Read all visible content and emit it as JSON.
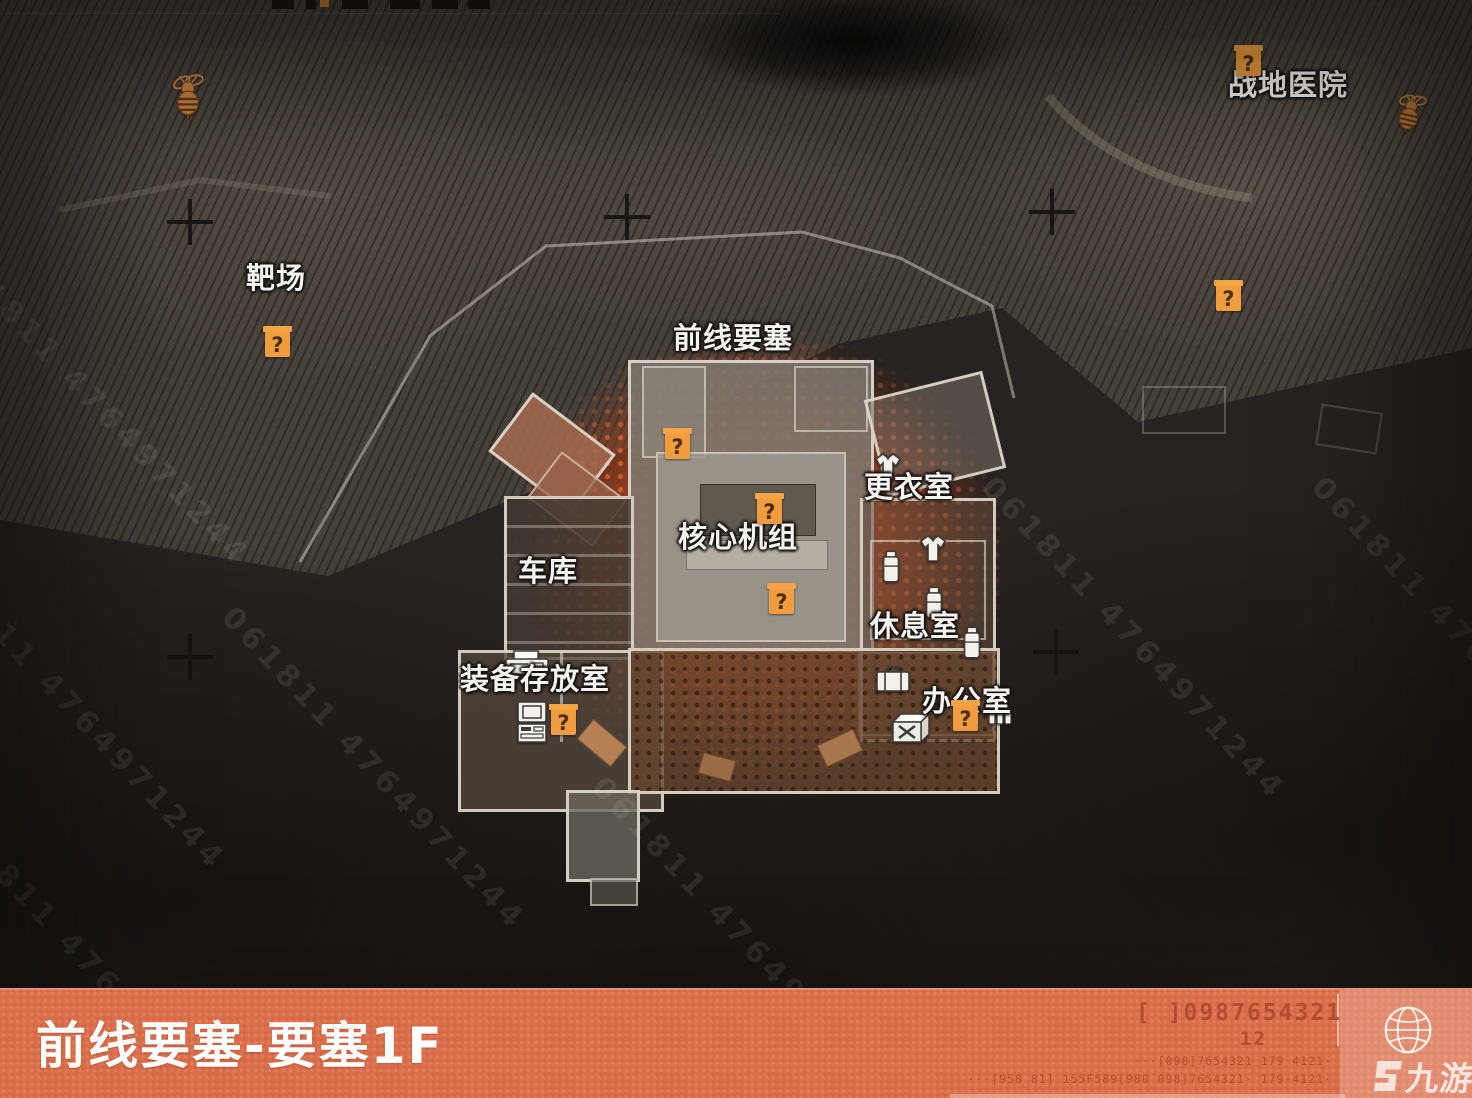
{
  "banner": {
    "title": "前线要塞-要塞1F",
    "code_main": "[ ]0987654321",
    "code_sub": "12",
    "code_line3": "···[098]7654321 179 4121·",
    "code_line4": "···[958 81] 155F589[980 098]7654321· 179·4121·",
    "logo_text": "九游"
  },
  "map": {
    "watermark": "061811 4764971244",
    "question_glyph": "?",
    "labels": {
      "field_hospital": "战地医院",
      "shooting_range": "靶场",
      "frontline_fortress": "前线要塞",
      "core_unit": "核心机组",
      "garage": "车库",
      "changing_room": "更衣室",
      "rest_room": "休息室",
      "equipment_storage": "装备存放室",
      "office": "办公室"
    }
  },
  "colors": {
    "banner_accent": "#dc6f4b",
    "marker_orange": "#ef9d3e",
    "glow_orange": "#bc4820"
  }
}
